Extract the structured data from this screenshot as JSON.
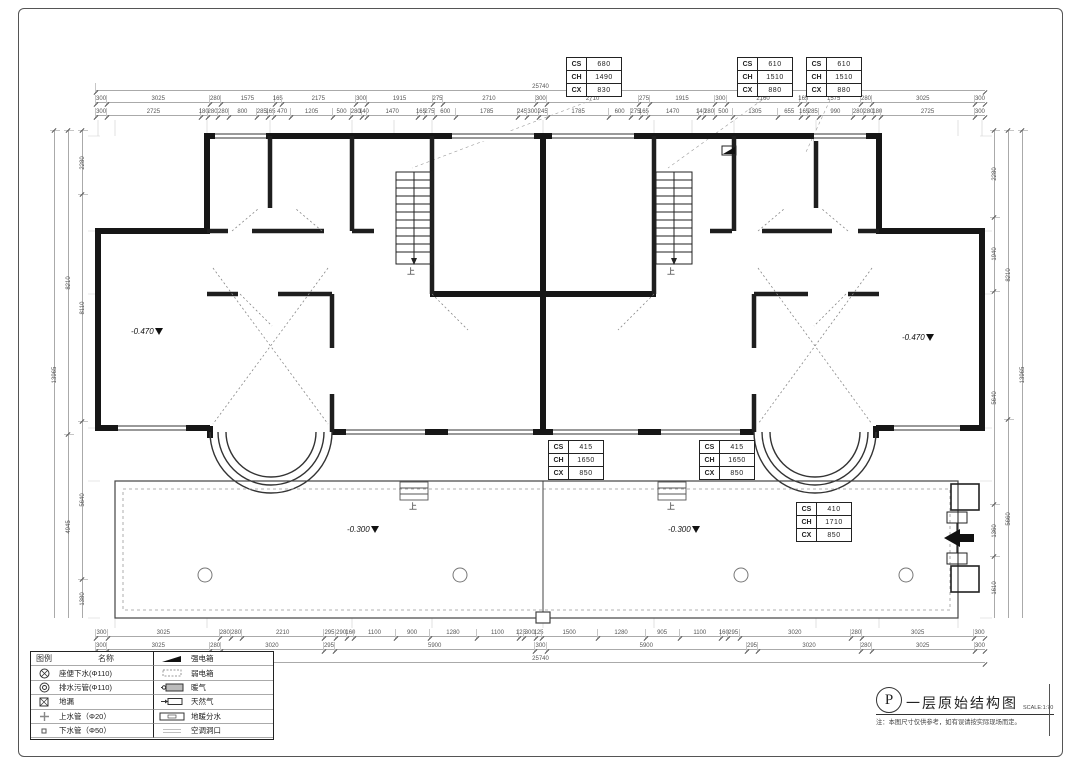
{
  "drawing": {
    "up_label": "上",
    "totals": {
      "top": "25740",
      "bottom": "25740"
    },
    "elevations": [
      {
        "value": "-0.470"
      },
      {
        "value": "-0.470"
      },
      {
        "value": "-0.300"
      },
      {
        "value": "-0.300"
      }
    ],
    "ceiling_tables": [
      {
        "rows": [
          {
            "k": "CS",
            "v": "680"
          },
          {
            "k": "CH",
            "v": "1490"
          },
          {
            "k": "CX",
            "v": "830"
          }
        ]
      },
      {
        "rows": [
          {
            "k": "CS",
            "v": "610"
          },
          {
            "k": "CH",
            "v": "1510"
          },
          {
            "k": "CX",
            "v": "880"
          }
        ]
      },
      {
        "rows": [
          {
            "k": "CS",
            "v": "610"
          },
          {
            "k": "CH",
            "v": "1510"
          },
          {
            "k": "CX",
            "v": "880"
          }
        ]
      },
      {
        "rows": [
          {
            "k": "CS",
            "v": "415"
          },
          {
            "k": "CH",
            "v": "1650"
          },
          {
            "k": "CX",
            "v": "850"
          }
        ]
      },
      {
        "rows": [
          {
            "k": "CS",
            "v": "415"
          },
          {
            "k": "CH",
            "v": "1650"
          },
          {
            "k": "CX",
            "v": "850"
          }
        ]
      },
      {
        "rows": [
          {
            "k": "CS",
            "v": "410"
          },
          {
            "k": "CH",
            "v": "1710"
          },
          {
            "k": "CX",
            "v": "850"
          }
        ]
      }
    ],
    "dims": {
      "top_row1": [
        "300",
        "3025",
        "280",
        "1575",
        "165",
        "2175",
        "300",
        "1915",
        "275",
        "2710",
        "300",
        "2710",
        "275",
        "1915",
        "300",
        "2160",
        "165",
        "1575",
        "280",
        "3025",
        "300"
      ],
      "top_row2": [
        "300",
        "2725",
        "180",
        "280",
        "280",
        "800",
        "285",
        "165",
        "470",
        "1205",
        "500",
        "280",
        "140",
        "1470",
        "165",
        "275",
        "600",
        "1785",
        "245",
        "300",
        "245",
        "1785",
        "600",
        "275",
        "165",
        "1470",
        "140",
        "280",
        "500",
        "1305",
        "655",
        "165",
        "285",
        "990",
        "280",
        "280",
        "180",
        "2725",
        "300"
      ],
      "bottom_row1": [
        "300",
        "3025",
        "280",
        "280",
        "2210",
        "295",
        "290",
        "160",
        "1100",
        "900",
        "1280",
        "1100",
        "125",
        "300",
        "125",
        "1500",
        "1280",
        "905",
        "1100",
        "160",
        "295",
        "3020",
        "280",
        "3025",
        "300"
      ],
      "bottom_row2": [
        "300",
        "3025",
        "280",
        "3020",
        "295",
        "5900",
        "300",
        "5900",
        "295",
        "3020",
        "280",
        "3025",
        "300"
      ],
      "left_outer": [
        "13965"
      ],
      "left_mid": [
        "8210",
        "4945"
      ],
      "left_inner": [
        "2280",
        "8110",
        "5640",
        "1380"
      ],
      "right_inner": [
        "2280",
        "1940",
        "5640",
        "1360",
        "1610"
      ],
      "right_mid": [
        "8210",
        "5660"
      ],
      "right_outer": [
        "13965"
      ]
    }
  },
  "legend": {
    "header": {
      "symbol": "图例",
      "name": "名称"
    },
    "left_items": [
      {
        "label": "座便下水(Φ110)"
      },
      {
        "label": "排水污管(Φ110)"
      },
      {
        "label": "地漏"
      },
      {
        "label": "上水管（Φ20）"
      },
      {
        "label": "下水管（Φ50）"
      }
    ],
    "right_items": [
      {
        "label": "强电箱"
      },
      {
        "label": "弱电箱"
      },
      {
        "label": "暖气"
      },
      {
        "label": "天然气"
      },
      {
        "label": "地暖分水"
      },
      {
        "label": "空调洞口"
      }
    ]
  },
  "title_block": {
    "symbol": "P",
    "title": "一层原始结构图",
    "scale": "SCALE:1:70",
    "note": "注：本图尺寸仅供参考，如有误请按实际现场而定。"
  }
}
